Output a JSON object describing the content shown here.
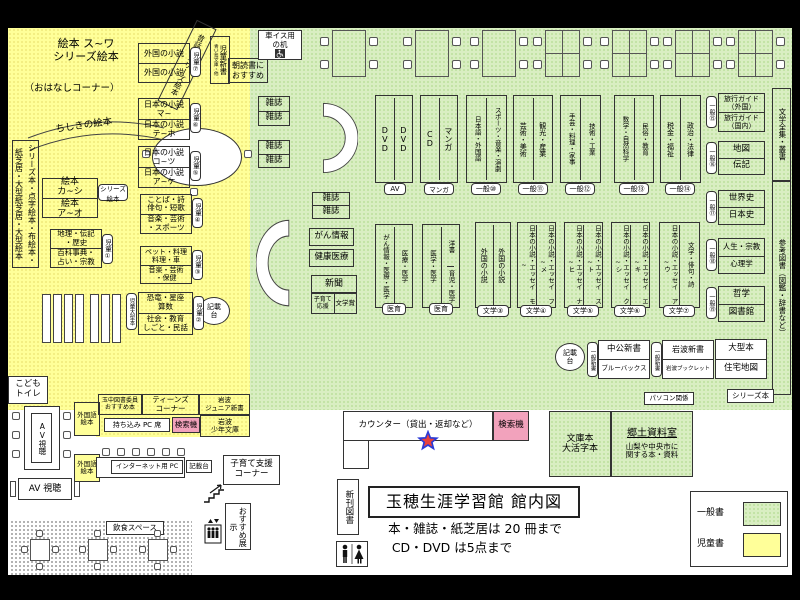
{
  "colors": {
    "children_bg": "#ffff99",
    "general_bg": "#d9eec2",
    "search_bg": "#f2a2bc",
    "star_fill": "#e8413c",
    "star_stroke": "#2b3bd6"
  },
  "title": {
    "main": "玉穂生涯学習館 館内図",
    "rule_books": "本・雑誌・紙芝居は 20 冊まで",
    "rule_av": "CD・DVD は5点まで"
  },
  "legend": {
    "general_label": "一般書",
    "children_label": "児童書"
  },
  "children": {
    "ehon_top": "絵本 ス~ワ\nシリーズ絵本",
    "ohanashi": "（おはなしコーナー）",
    "mukashibanashi": "昔話・シリーズ絵本",
    "chishiki": "ちしきの絵本",
    "side_shelf": "シリーズ本・点字絵本・布絵本・紙芝居・大型紙芝居・大型絵本",
    "ehon_ka": "絵本\nカ~シ",
    "ehon_a": "絵本\nア~オ",
    "series_ehon": "シリーズ\n絵本",
    "chiri": "地理・伝記\n・歴史",
    "hyakka": "百科事典・\n占い・宗教",
    "tag1": "児童①",
    "gaikoku1": "外国の小説",
    "gaikoku2": "外国の小説",
    "tag7": "児童⑦",
    "jido_shinsho": "児童新書",
    "aoitori": "青い鳥文庫・他",
    "asadoku": "朝読書に\nおすすめ",
    "nihon_ma": "日本の小説\nマ~",
    "nihon_te": "日本の小説\nテ~ホ",
    "tag6": "児童⑥",
    "nihon_ko": "日本の小説\nコ~ツ",
    "nihon_a": "日本の小説\nア~ケ",
    "tag5": "児童⑤",
    "kotoba": "ことば・詩\n俳句・短歌",
    "ongaku_sports": "音楽・芸術\n・スポーツ",
    "tag4": "児童④",
    "pet": "ペット・料理\n料理・車",
    "ongaku_hoken": "音楽・芸術\n・保健",
    "tag3": "児童③",
    "kyoryu": "恐竜・星座\n算数",
    "shakai": "社会・教育\nしごと・民話",
    "tag2": "児童②",
    "ogata_tag": "児童大型本",
    "kisaidai": "記載\n台",
    "kodomo_toilet": "こども\nトイレ"
  },
  "general": {
    "wheelchair_desk": "車イス用\nの机",
    "mag": "雑誌",
    "gan_joho": "がん情報",
    "kenko": "健康医療",
    "shinbun": "新聞",
    "kosodate_ouen": "子育て\n応援",
    "bungakusho": "文学賞",
    "columns_top": [
      {
        "left": "DVD",
        "right": "DVD",
        "tag": "AV"
      },
      {
        "left": "CD",
        "right": "マンガ",
        "tag": "マンガ"
      },
      {
        "left": "日本語・外国語",
        "right": "スポーツ・音楽・演劇",
        "tag": "一般⑩"
      },
      {
        "left": "芸術・美術",
        "right": "観光・産業",
        "tag": "一般⑪"
      },
      {
        "left": "手芸・料理・家事",
        "right": "技術・工業",
        "tag": "一般⑫"
      },
      {
        "left": "数学・自然科学",
        "right": "民俗・教育",
        "tag": "一般⑬"
      },
      {
        "left": "税金・福祉",
        "right": "政治・法律",
        "tag": "一般⑭"
      }
    ],
    "columns_mid": [
      {
        "left": "がん情報・医療・医学",
        "right": "医療・医学",
        "tag": "医育"
      },
      {
        "left": "医学・医学",
        "right_top": "洋書",
        "right_bottom": "育児・医学",
        "tag": "医育"
      },
      {
        "left": "外国の小説",
        "right": "外国の小説",
        "tag": "文学③"
      },
      {
        "left": "日本の小説・エッセイ モ~",
        "right": "日本の小説・エッセイ フ~メ",
        "tag": "文学④"
      },
      {
        "left": "日本の小説・エッセイ ナ~ヒ",
        "right": "日本の小説・エッセイ ス~ト",
        "tag": "文学⑤"
      },
      {
        "left": "日本の小説・エッセイ ク~シ",
        "right": "日本の小説・エッセイ エ~キ",
        "tag": "文学⑥"
      },
      {
        "left": "日本の小説・エッセイ ア~ウ",
        "right": "文学・俳句・詩",
        "tag": "文学⑦"
      }
    ],
    "right_shelves": [
      {
        "tag": "一般⑮",
        "top": "旅行ガイド\n（外国）",
        "bottom": "旅行ガイド\n（国内）"
      },
      {
        "tag": "一般⑯",
        "top": "地図",
        "bottom": "伝記"
      },
      {
        "tag": "一般⑰",
        "top": "世界史",
        "bottom": "日本史"
      },
      {
        "tag": "一般⑱",
        "top": "人生・宗教",
        "bottom": "心理学"
      },
      {
        "tag": "一般⑲",
        "top": "哲学",
        "bottom": "図書館"
      }
    ],
    "ogata": "大型本",
    "jutaku": "住宅地図",
    "bungaku_zenshu": "文学全集・叢書",
    "sanko_tosho": "参考図書（図鑑・辞書など）",
    "series_bon": "シリーズ本",
    "shinsho_tag": "一般新書",
    "chuko": "中公新書",
    "bluebacks": "ブルーバックス",
    "iwanami_shinsho": "岩波新書",
    "iwanami_booklet": "岩波ブックレット",
    "pasokon": "パソコン関係",
    "kisaidai": "記載\n台"
  },
  "counter": {
    "label": "カウンター（貸出・返却など）",
    "search": "検索機"
  },
  "south": {
    "bunko": "文庫本\n大活字本",
    "kyodo_title": "郷土資料室",
    "kyodo_body": "山梨や中央市に\n関する本・資料",
    "shinkan": "新刊図書",
    "av_table": "AV視聴",
    "av_box": "AV 視聴",
    "gaikokugo_ehon": "外国語\n絵本",
    "recommend": "玉中図書委員\nおすすめ本",
    "teens": "ティーンズ\nコーナー",
    "iwanami_jr": "岩波\nジュニア新書",
    "pc_seat": "持ち込み PC 席",
    "search2": "検索機",
    "iwanami_shonen": "岩波\n少年文庫",
    "internet_pc": "インターネット用 PC",
    "kisaidai3": "記載台",
    "kosodate": "子育て支援\nコーナー",
    "osusume": "おすすめ展示",
    "inshoku": "飲食スペース"
  }
}
